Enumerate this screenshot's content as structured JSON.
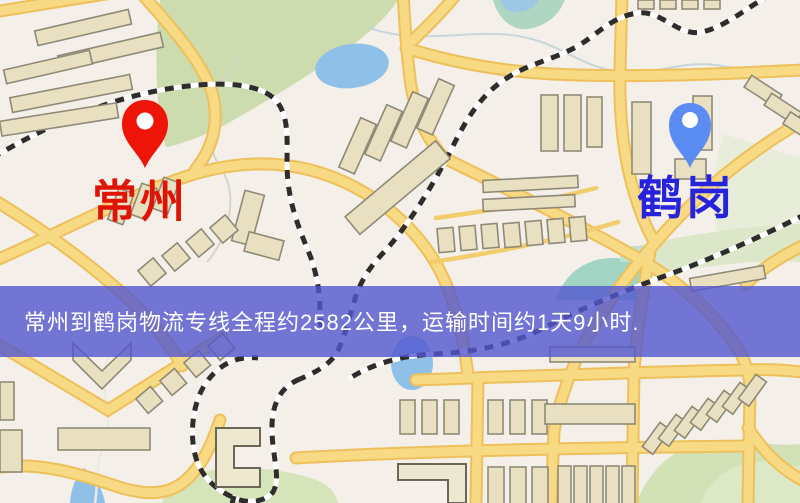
{
  "map": {
    "origin": {
      "name": "常州",
      "pin_color": "#ee1408",
      "label_color": "#e01404"
    },
    "destination": {
      "name": "鹤岗",
      "pin_color": "#5b8cf2",
      "label_color": "#2722dc"
    },
    "banner": {
      "text": "常州到鹤岗物流专线全程约2582公里，运输时间约1天9小时.",
      "distance": "约2582公里",
      "duration": "约1天9小时",
      "background_color": "rgba(83,86,208,0.80)",
      "text_color": "#ffffff"
    },
    "palette": {
      "map_background": "#f4efe8",
      "road_fill": "#f8da84",
      "road_casing": "#edc05c",
      "park_green": "#ccdcae",
      "water_blue": "#8fc0e8",
      "railway_dark": "#2e2d2b",
      "building_fill": "#e9e0c2",
      "building_outline": "#8f8a77"
    }
  }
}
